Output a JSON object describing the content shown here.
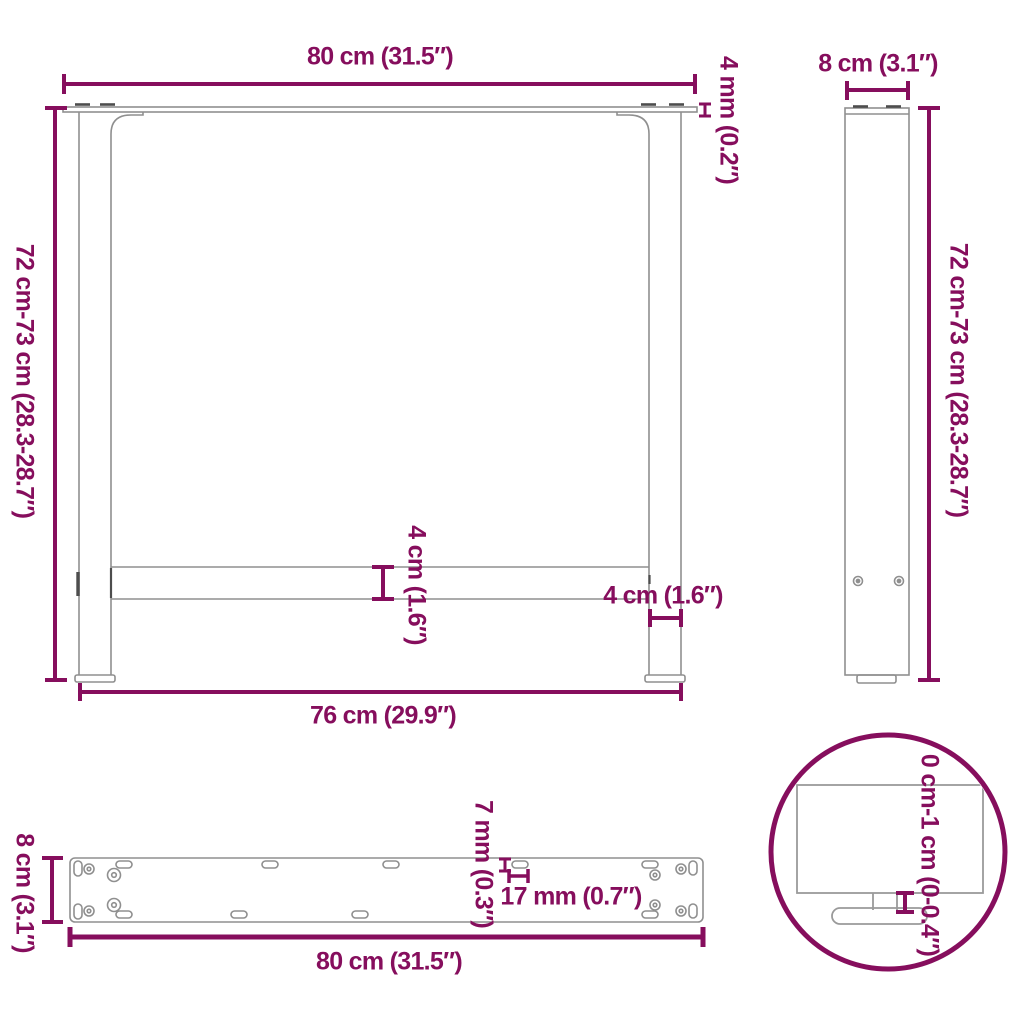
{
  "diagram_type": "furniture dimension drawing (table legs, front / side / bottom views with detail circle)",
  "colors": {
    "annotation": "#860E5D",
    "outline": "#8F8F8F",
    "dark_marks": "#4D4D4D",
    "background": "#FFFFFF"
  },
  "front_view": {
    "top_width_label": "80 cm (31.5″)",
    "top_plate_thickness_label": "4 mm (0.2″)",
    "height_label": "72 cm-73 cm (28.3-28.7″)",
    "crossbar_height_label": "4 cm (1.6″)",
    "leg_width_label": "4 cm (1.6″)",
    "feet_span_label": "76 cm (29.9″)"
  },
  "side_view": {
    "depth_label": "8 cm (3.1″)",
    "height_label": "72 cm-73 cm (28.3-28.7″)"
  },
  "bottom_view": {
    "depth_label": "8 cm (3.1″)",
    "hole_diameter_label": "7 mm (0.3″)",
    "slot_length_label": "17 mm (0.7″)",
    "length_label": "80 cm (31.5″)"
  },
  "detail_view": {
    "height_adjustment_label": "0 cm-1 cm (0-0.4″)"
  }
}
